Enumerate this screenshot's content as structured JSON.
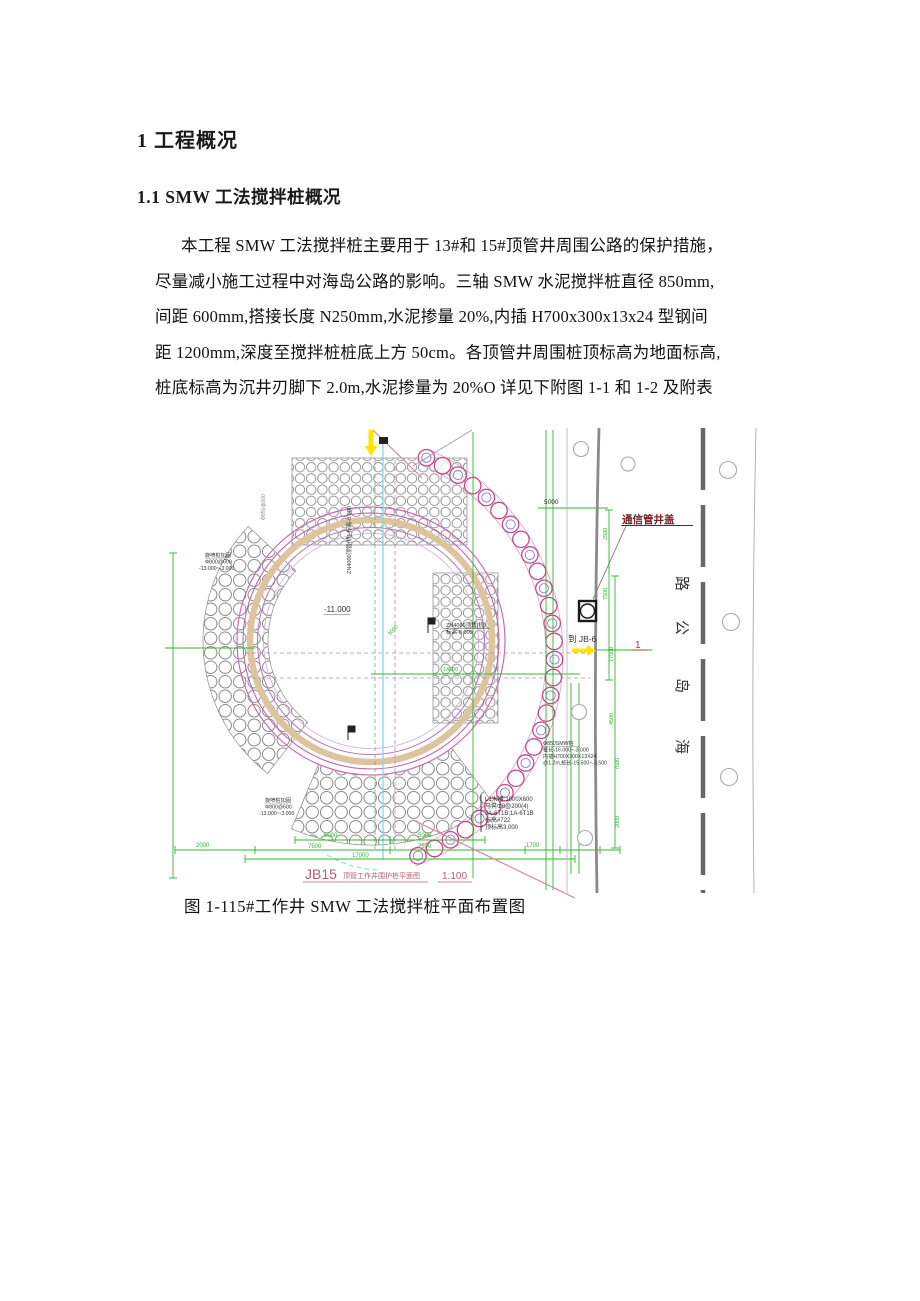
{
  "document": {
    "heading1": "1 工程概况",
    "heading2": "1.1  SMW 工法搅拌桩概况",
    "paragraph_lines": [
      "本工程 SMW 工法搅拌桩主要用于 13#和 15#顶管井周围公路的保护措施，",
      "尽量减小施工过程中对海岛公路的影响。三轴 SMW 水泥搅拌桩直径 850mm,",
      "间距 600mm,搭接长度 N250mm,水泥掺量 20%,内插 H700x300x13x24 型钢间",
      "距 1200mm,深度至搅拌桩桩底上方 50cm。各顶管井周围桩顶标高为地面标高,",
      "桩底标高为沉井刃脚下 2.0m,水泥掺量为 20%O 详见下附图 1-1 和 1-2 及附表"
    ],
    "figure_caption": "图 1-115#工作井 SMW 工法搅拌桩平面布置图"
  },
  "drawing": {
    "title_prefix": "JB15",
    "title_name": "顶管工作井围护桩平面图",
    "title_scale": "1:100",
    "labels": {
      "comm_manhole": "通信管井盖",
      "to_jb6": "到 JB-6",
      "center_level": "-11.000",
      "zn4000_1": "ZN4000顶管(机)",
      "zn4000_2": "标高-8.000",
      "zn4000_vertical": "ZN4000顶管(机) 标高-8.000",
      "road_char_1": "路",
      "road_char_2": "公",
      "road_char_3": "岛",
      "road_char_4": "海",
      "section_no": "1",
      "angle_dim": "3000",
      "grid_spec_rotated": "Φ850@600",
      "jet_note_1": "旋喷桩加固",
      "jet_note_2": "Φ800@600",
      "jet_note_3": "-13.000~-3.000",
      "smw_note_1": "Φ850SMW桩",
      "smw_note_2": "桩长-16.000~-3.000",
      "smw_note_3": "内插H700X300X13X24",
      "smw_note_4": "@1.2m,桩长-15.500~-3.500",
      "detail_note_1": "L1米槽:1000X600",
      "detail_note_2": "马凳Φ8@200(4)",
      "detail_note_3": "JA-6T1B;1A-6T1B",
      "detail_note_4": "标高#722",
      "detail_note_5": "顶标高3.000"
    },
    "dims": {
      "top_right": "5000",
      "col_1": "2500",
      "col_2": "7500",
      "col_3": "17500",
      "col_4": "4500",
      "col_5": "7500",
      "col_6": "2000",
      "row1_1": "5000",
      "row1_2": "5000",
      "row2_1": "2000",
      "row2_2": "7500",
      "row2_3": "7500",
      "row2_4": "1700",
      "total": "17000",
      "center": "14000"
    }
  }
}
